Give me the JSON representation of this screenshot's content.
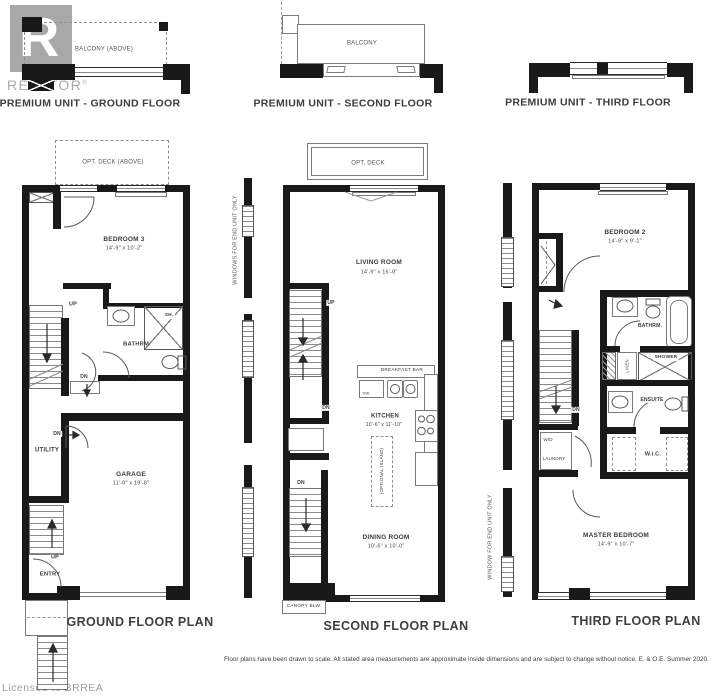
{
  "watermark": {
    "realtor_logo_letter": "R",
    "realtor_text": "REALTOR",
    "registered": "®",
    "licensed": "Licensed to BRREA"
  },
  "header_row": {
    "ground": {
      "balcony": "BALCONY (ABOVE)",
      "title": "PREMIUM UNIT - GROUND FLOOR"
    },
    "second": {
      "balcony": "BALCONY",
      "title": "PREMIUM UNIT - SECOND FLOOR"
    },
    "third": {
      "title": "PREMIUM UNIT - THIRD FLOOR"
    }
  },
  "ground_floor": {
    "title": "GROUND FLOOR PLAN",
    "deck": "OPT. DECK (ABOVE)",
    "bedroom3_name": "BEDROOM 3",
    "bedroom3_dims": "14'-9\" x 10'-2\"",
    "up1": "UP",
    "dn_hall": "DN",
    "bathroom": "BATHRM.",
    "shower": "SH.",
    "utility": "UTILITY",
    "dn_utility": "DN",
    "garage_name": "GARAGE",
    "garage_dims": "11'-0\" x 19'-8\"",
    "up2": "UP",
    "entry": "ENTRY"
  },
  "second_floor": {
    "title": "SECOND FLOOR PLAN",
    "deck": "OPT. DECK",
    "end_unit_note": "WINDOWS FOR END UNIT ONLY",
    "living_name": "LIVING ROOM",
    "living_dims": "14'-9\" x 16'-0\"",
    "up": "UP",
    "dn1": "DN",
    "dn2": "DN",
    "breakfast_bar": "BREAKFAST BAR",
    "dw": "DW",
    "kitchen_name": "KITCHEN",
    "kitchen_dims": "10'-6\" x 11'-10\"",
    "island": "(OPTIONAL ISLAND)",
    "dining_name": "DINING ROOM",
    "dining_dims": "10'-6\" x 10'-0\"",
    "canopy": "CANOPY BLW."
  },
  "third_floor": {
    "title": "THIRD FLOOR PLAN",
    "end_unit_note": "WINDOW FOR END UNIT ONLY",
    "bedroom2_name": "BEDROOM 2",
    "bedroom2_dims": "14'-9\" x 9'-1\"",
    "bathroom": "BATHRM.",
    "linen": "LINEN",
    "shower": "SHOWER",
    "ensuite": "ENSUITE",
    "wd": "W/D",
    "laundry": "LAUNDRY",
    "wic": "W.I.C.",
    "dn": "DN",
    "master_name": "MASTER BEDROOM",
    "master_dims": "14'-9\" x 10'-7\""
  },
  "footer": {
    "disclaimer": "Floor plans have been drawn to scale. All stated area measurements are approximate inside dimensions and are subject to change without notice. E. & O.E. Summer 2020."
  }
}
